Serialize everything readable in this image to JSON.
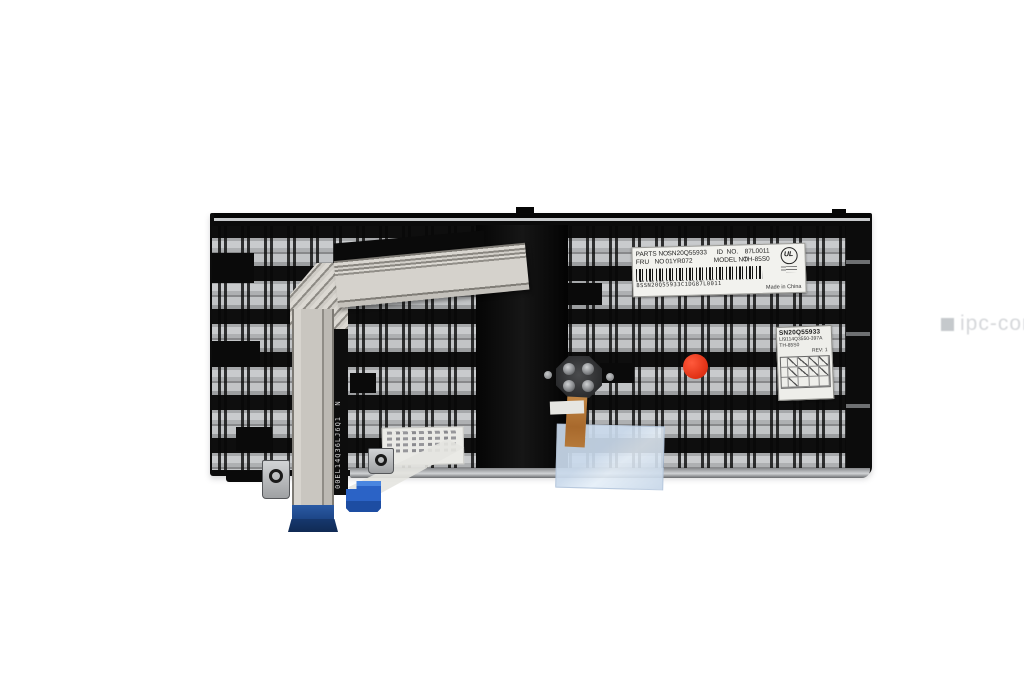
{
  "scene": {
    "background_color": "#ffffff",
    "subject": "laptop keyboard rear view product photo"
  },
  "watermark": {
    "text": "ipc-computer",
    "color": "#9aa0a6"
  },
  "colors": {
    "trackpoint_cap_red": "#e23317",
    "connector_blue": "#2b63c4",
    "cable_end_blue": "#1c4484",
    "tape_blue": "#cddcec",
    "plate_silver": "#b0b2b4",
    "plate_black": "#0d0d0d"
  },
  "main_label": {
    "parts_label": "PARTS NO",
    "parts_value": "SN20Q55933",
    "id_label": "ID  NO.",
    "id_value": "87L0011",
    "fru_label": "FRU   NO",
    "fru_value": "01YR072",
    "model_label": "MODEL NO",
    "model_value": "TH-85S0",
    "barcode_text": "8SSN20Q55933C1DG87L0011",
    "cert_mark": "UL",
    "origin": "Made in China"
  },
  "qc_label": {
    "part_no": "SN20Q55933",
    "code_line": "LI9114Q3550-397A",
    "model_line": "TH-85S0",
    "rev": "REV: 1"
  },
  "cable_print": {
    "text": "00EL14Q36LJ6Q1  N"
  }
}
